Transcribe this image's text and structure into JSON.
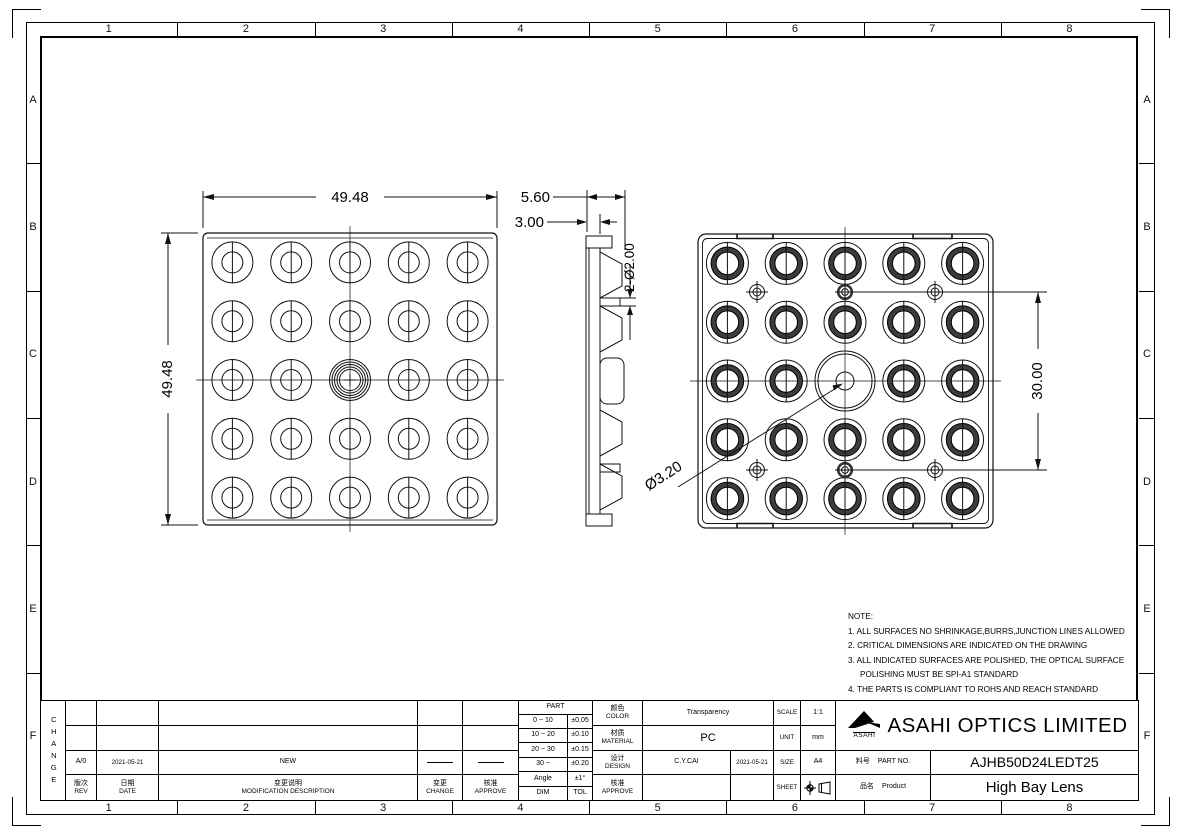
{
  "drawing": {
    "zones": {
      "cols": [
        "1",
        "2",
        "3",
        "4",
        "5",
        "6",
        "7",
        "8"
      ],
      "rows": [
        "A",
        "B",
        "C",
        "D",
        "E",
        "F"
      ]
    },
    "dims": {
      "front_width": "49.48",
      "front_height": "49.48",
      "side_total": "5.60",
      "side_base": "3.00",
      "side_pins": "2-Ø2.00",
      "back_pin_spacing": "30.00",
      "back_center_bore": "Ø3.20"
    },
    "notes": {
      "title": "NOTE:",
      "lines": [
        "1. ALL SURFACES NO SHRINKAGE,BURRS,JUNCTION LINES ALLOWED",
        "2. CRITICAL DIMENSIONS ARE INDICATED ON THE DRAWING",
        "3. ALL INDICATED SURFACES ARE POLISHED, THE OPTICAL SURFACE",
        "POLISHING MUST BE SPI-A1 STANDARD",
        "4. THE PARTS IS COMPLIANT TO ROHS AND REACH STANDARD"
      ]
    }
  },
  "title_block": {
    "change_label": "CHANGE",
    "revision": {
      "rev": "A/0",
      "date": "2021-05-21",
      "description": "NEW"
    },
    "headers": {
      "rev_zh": "版次",
      "rev_en": "REV",
      "date_zh": "日期",
      "date_en": "DATE",
      "desc_zh": "变更说明",
      "desc_en": "MODIFICATION DESCRIPTION",
      "change_zh": "变更",
      "change_en": "CHANGE",
      "approve_zh": "核准",
      "approve_en": "APPROVE"
    },
    "tolerance": {
      "header": "PART",
      "rows": [
        [
          "0 ~ 10",
          "±0.05"
        ],
        [
          "10 ~ 20",
          "±0.10"
        ],
        [
          "20 ~ 30",
          "±0.15"
        ],
        [
          "30 ~",
          "±0.20"
        ],
        [
          "Angle",
          "±1°"
        ]
      ],
      "footer": [
        "DIM",
        "TOL"
      ]
    },
    "info": {
      "color_zh": "颜色",
      "color_en": "COLOR",
      "color_value": "Transparency",
      "material_zh": "材质",
      "material_en": "MATERIAL",
      "material_value": "PC",
      "design_zh": "设计",
      "design_en": "DESIGN",
      "design_by": "C.Y.CAI",
      "design_date": "2021-05-21",
      "approve_zh": "核准",
      "approve_en": "APPROVE",
      "approve_by": "",
      "approve_date": ""
    },
    "meta": {
      "scale_label": "SCALE",
      "scale": "1:1",
      "unit_label": "UNIT",
      "unit": "mm",
      "size_label": "SIZE",
      "size": "A4",
      "sheet_label": "SHEET"
    },
    "brand": {
      "logo_text": "ASAHI",
      "company": "ASAHI OPTICS LIMITED",
      "part_no_zh": "料号",
      "part_no_en": "PART NO.",
      "part_no": "AJHB50D24LEDT25",
      "product_zh": "品名",
      "product_en": "Product",
      "product": "High Bay Lens"
    }
  }
}
